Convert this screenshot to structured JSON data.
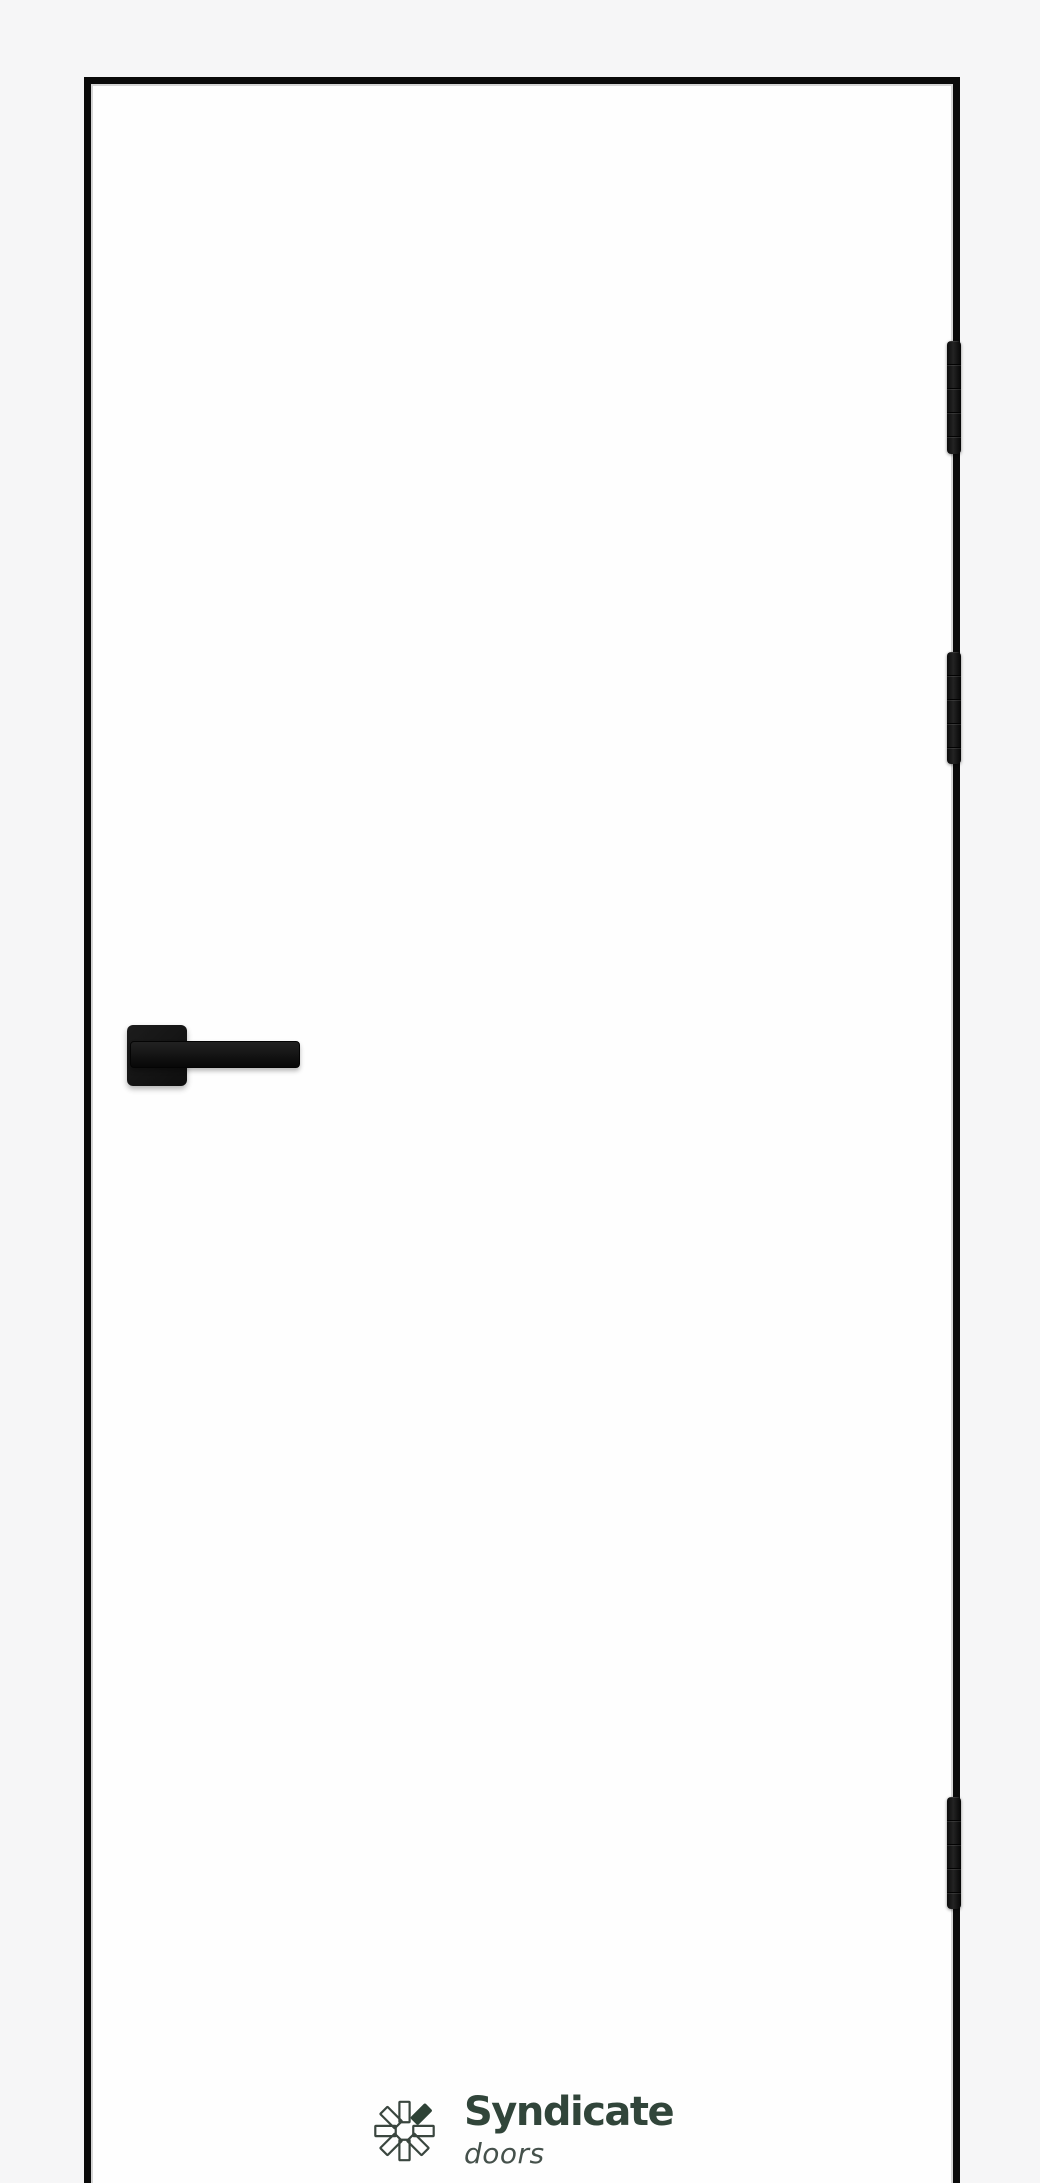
{
  "brand": {
    "name": "Syndicate",
    "tagline": "doors",
    "logo_icon": "pinwheel-petals-icon"
  },
  "door": {
    "type": "flush interior door, right-hinged",
    "hinge_count": 3,
    "handle": "square-rosette lever handle, left side"
  },
  "colors": {
    "bg": "#f6f6f7",
    "door-fill": "#fefefe",
    "frame": "#0a0a0a",
    "hardware": "#141414",
    "brand-green": "#31453a",
    "tagline-gray": "#45514b"
  }
}
